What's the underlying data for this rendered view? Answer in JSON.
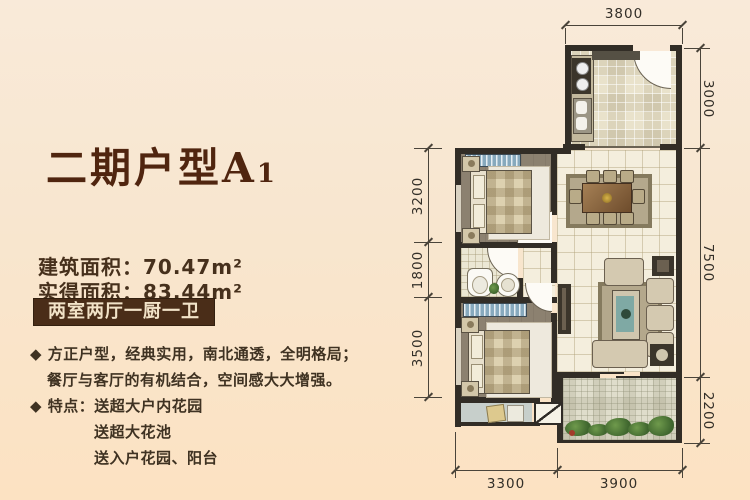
{
  "left_panel": {
    "title_main": "二期户型A",
    "title_sub": "1",
    "area_rows": [
      {
        "label": "建筑面积：",
        "value": "70.47",
        "unit": "m²"
      },
      {
        "label": "实得面积：",
        "value": "83.44",
        "unit": "m²"
      }
    ],
    "badge": "两室两厅一厨一卫",
    "features": [
      "◆ 方正户型，经典实用，南北通透，全明格局；",
      "餐厅与客厅的有机结合，空间感大大增强。",
      "◆ 特点：送超大户内花园",
      "送超大花池",
      "送入户花园、阳台"
    ]
  },
  "floor_plan": {
    "dimensions": {
      "top": [
        "3800"
      ],
      "right": [
        "3000",
        "7500",
        "2200"
      ],
      "left": [
        "3200",
        "1800",
        "3500"
      ],
      "bottom": [
        "3300",
        "3900"
      ]
    },
    "colors": {
      "background": "#f8e6cf",
      "title_brown": "#50250f",
      "badge_brown": "#4a2d18",
      "wall_dark": "#322d26",
      "floor_cream": "#f4eedd",
      "floor_bedroom": "#8c8170",
      "window_blue": "#87a9bd",
      "dimension_text": "#332f28"
    }
  }
}
